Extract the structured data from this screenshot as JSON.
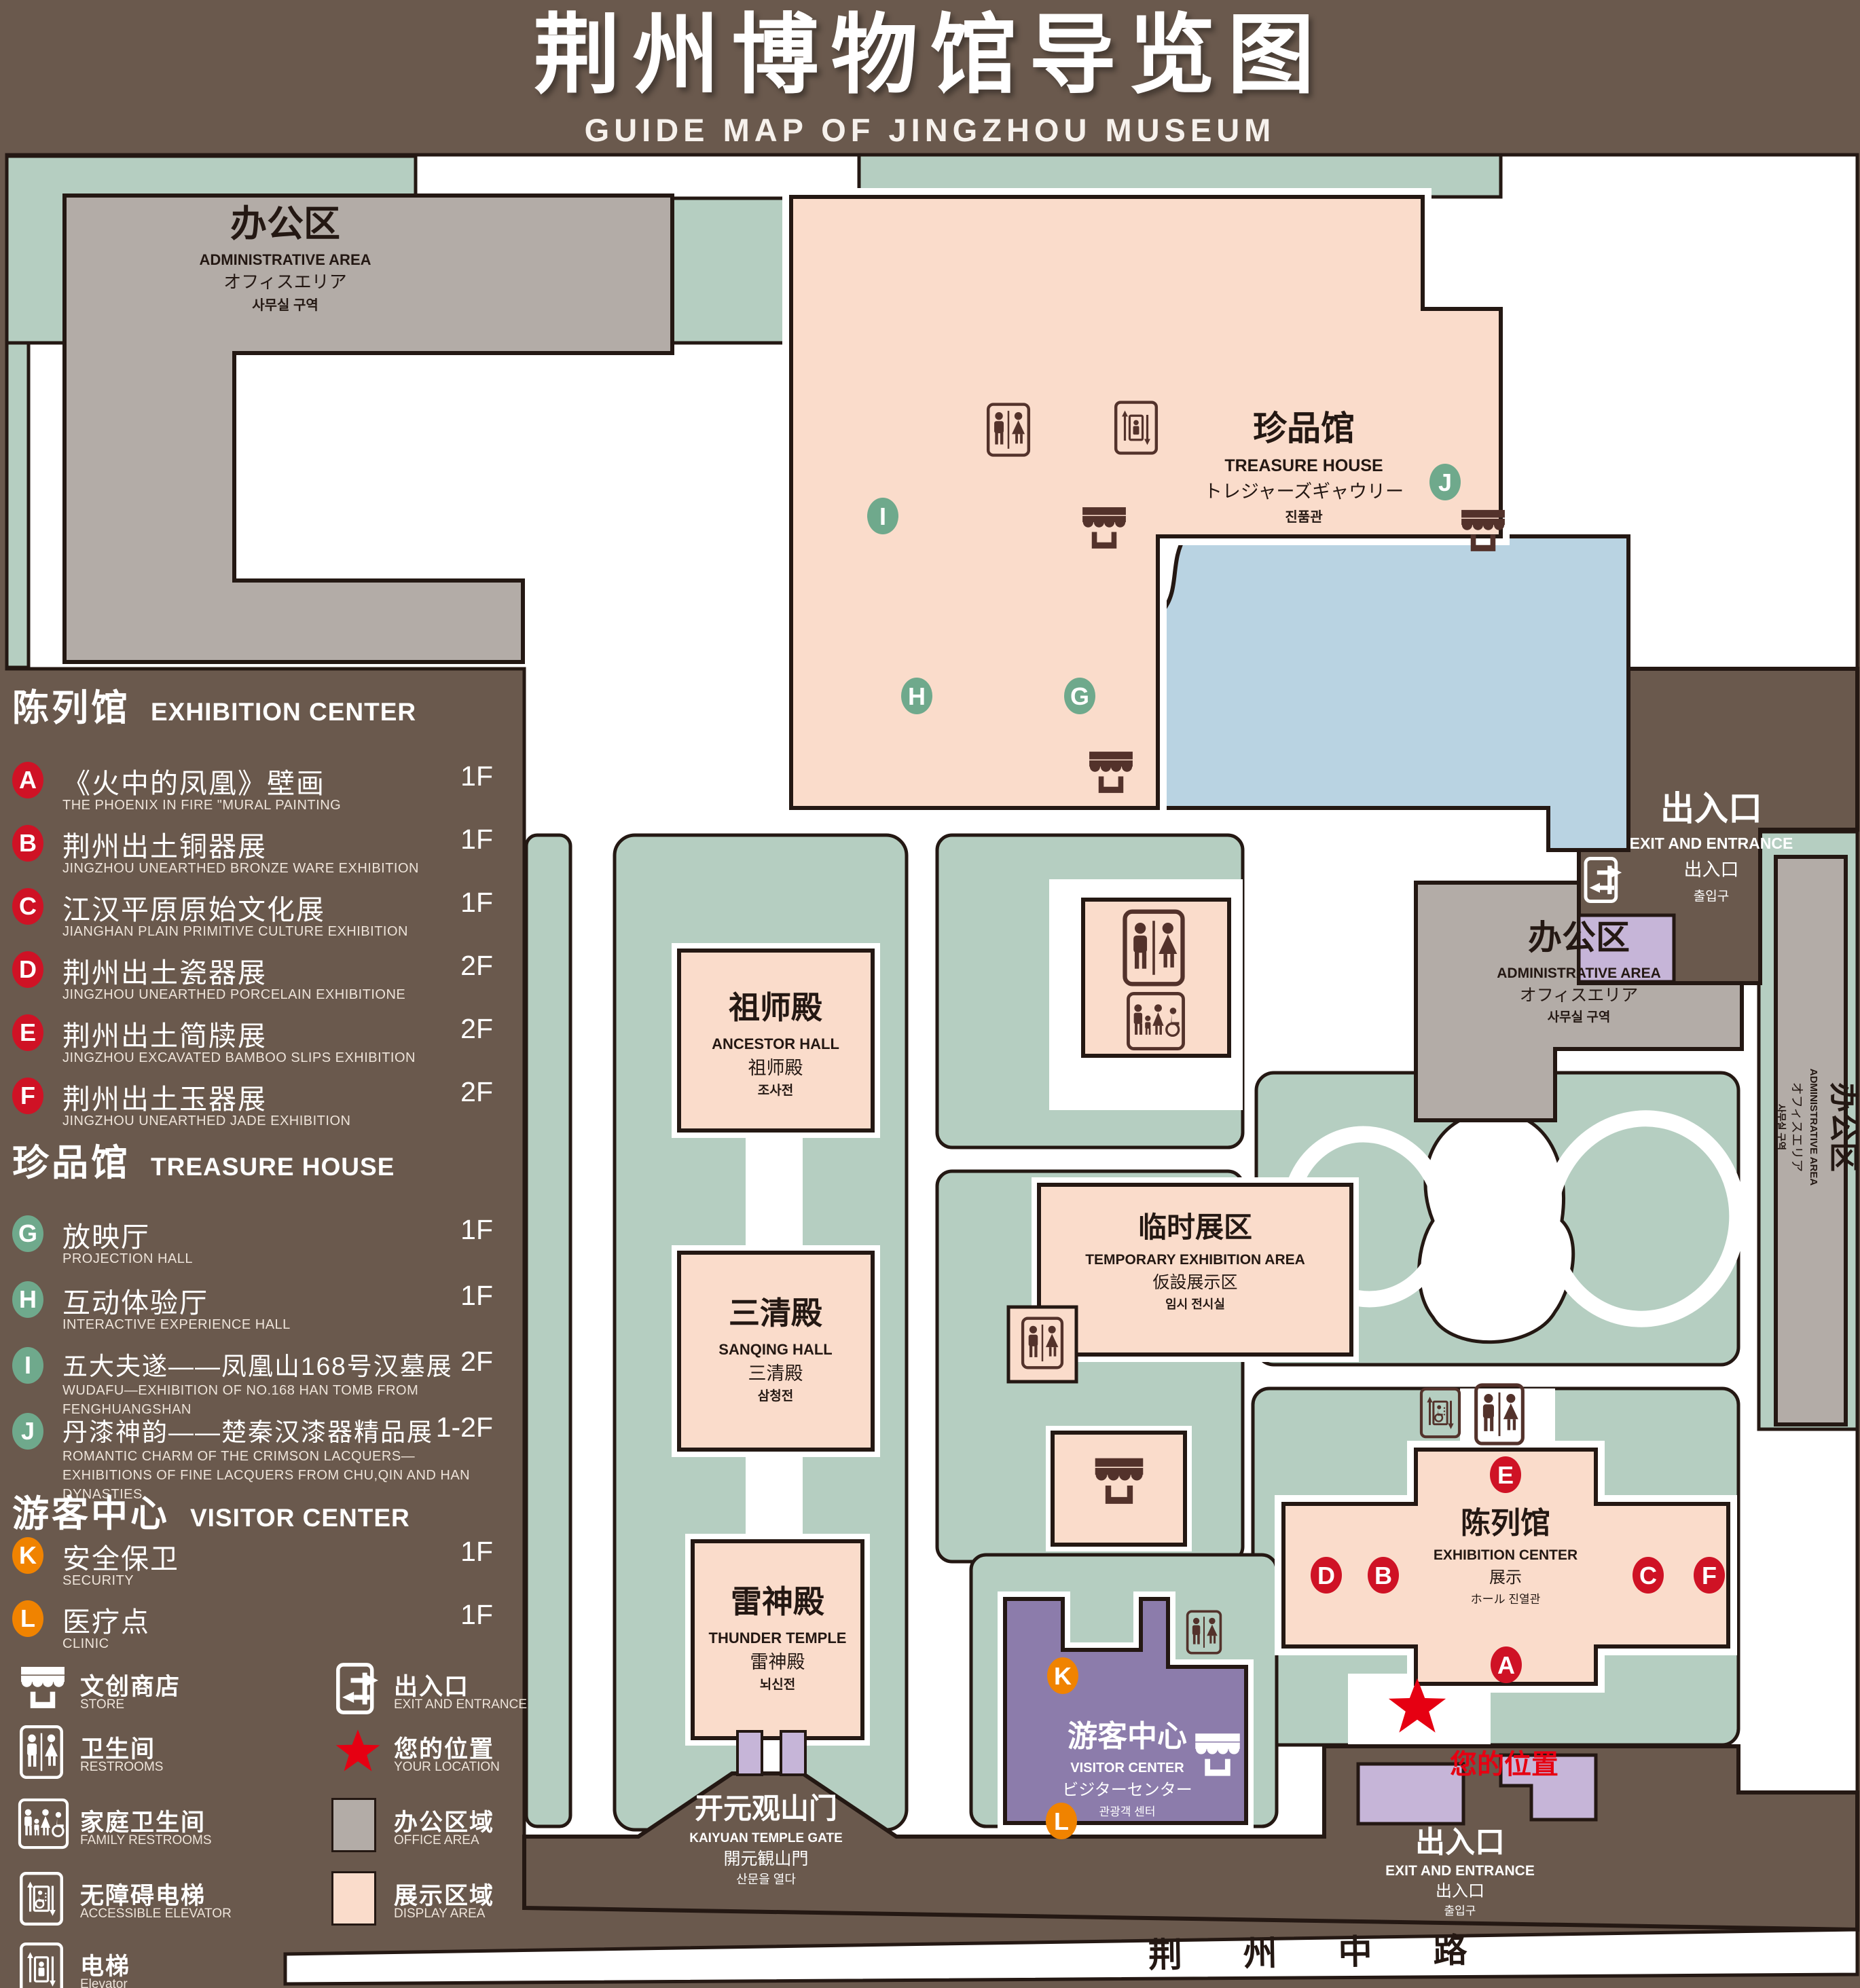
{
  "header": {
    "title": "荆州博物馆导览图",
    "subtitle": "GUIDE MAP OF JINGZHOU MUSEUM"
  },
  "legend": {
    "sections": [
      {
        "zh": "陈列馆",
        "en": "EXHIBITION CENTER",
        "items": [
          {
            "letter": "A",
            "zh": "《火中的凤凰》壁画",
            "en": "THE PHOENIX IN FIRE \"MURAL PAINTING",
            "floor": "1F"
          },
          {
            "letter": "B",
            "zh": "荆州出土铜器展",
            "en": "JINGZHOU UNEARTHED BRONZE WARE EXHIBITION",
            "floor": "1F"
          },
          {
            "letter": "C",
            "zh": "江汉平原原始文化展",
            "en": "JIANGHAN PLAIN PRIMITIVE CULTURE EXHIBITION",
            "floor": "1F"
          },
          {
            "letter": "D",
            "zh": "荆州出土瓷器展",
            "en": "JINGZHOU UNEARTHED PORCELAIN EXHIBITIONE",
            "floor": "2F"
          },
          {
            "letter": "E",
            "zh": "荆州出土简牍展",
            "en": "JINGZHOU EXCAVATED BAMBOO SLIPS EXHIBITION",
            "floor": "2F"
          },
          {
            "letter": "F",
            "zh": "荆州出土玉器展",
            "en": "JINGZHOU UNEARTHED JADE EXHIBITION",
            "floor": "2F"
          }
        ]
      },
      {
        "zh": "珍品馆",
        "en": "TREASURE HOUSE",
        "items": [
          {
            "letter": "G",
            "zh": "放映厅",
            "en": "PROJECTION HALL",
            "floor": "1F"
          },
          {
            "letter": "H",
            "zh": "互动体验厅",
            "en": "INTERACTIVE EXPERIENCE HALL",
            "floor": "1F"
          },
          {
            "letter": "I",
            "zh": "五大夫遂——凤凰山168号汉墓展",
            "en": "WUDAFU—EXHIBITION OF NO.168 HAN TOMB FROM FENGHUANGSHAN",
            "floor": "2F"
          },
          {
            "letter": "J",
            "zh": "丹漆神韵——楚秦汉漆器精品展",
            "en": "ROMANTIC CHARM OF THE CRIMSON LACQUERS—EXHIBITIONS OF FINE LACQUERS FROM CHU,QIN AND HAN DYNASTIES",
            "floor": "1-2F"
          }
        ]
      },
      {
        "zh": "游客中心",
        "en": "VISITOR CENTER",
        "items": [
          {
            "letter": "K",
            "zh": "安全保卫",
            "en": "SECURITY",
            "floor": "1F"
          },
          {
            "letter": "L",
            "zh": "医疗点",
            "en": "CLINIC",
            "floor": "1F"
          }
        ]
      }
    ]
  },
  "icon_legend": {
    "store": {
      "zh": "文创商店",
      "en": "STORE"
    },
    "exit": {
      "zh": "出入口",
      "en": "EXIT AND ENTRANCE"
    },
    "restrooms": {
      "zh": "卫生间",
      "en": "RESTROOMS"
    },
    "location": {
      "zh": "您的位置",
      "en": "YOUR LOCATION"
    },
    "family": {
      "zh": "家庭卫生间",
      "en": "FAMILY RESTROOMS"
    },
    "office": {
      "zh": "办公区域",
      "en": "OFFICE AREA"
    },
    "accessible": {
      "zh": "无障碍电梯",
      "en": "ACCESSIBLE ELEVATOR"
    },
    "display": {
      "zh": "展示区域",
      "en": "DISPLAY AREA"
    },
    "elevator": {
      "zh": "电梯",
      "en": "Elevator"
    }
  },
  "map": {
    "admin": {
      "zh": "办公区",
      "en": "ADMINISTRATIVE AREA",
      "jp": "オフィスエリア",
      "kr": "사무실 구역"
    },
    "treasure": {
      "zh": "珍品馆",
      "en": "TREASURE HOUSE",
      "jp": "トレジャーズギャウリー",
      "kr": "진품관"
    },
    "exit": {
      "zh": "出入口",
      "en": "EXIT AND ENTRANCE",
      "jp": "出入口",
      "kr": "출입구"
    },
    "ancestor": {
      "zh": "祖师殿",
      "en": "ANCESTOR HALL",
      "jp": "祖师殿",
      "kr": "조사전"
    },
    "sanqing": {
      "zh": "三清殿",
      "en": "SANQING HALL",
      "jp": "三清殿",
      "kr": "삼청전"
    },
    "thunder": {
      "zh": "雷神殿",
      "en": "THUNDER TEMPLE",
      "jp": "雷神殿",
      "kr": "뇌신전"
    },
    "temporary": {
      "zh": "临时展区",
      "en": "TEMPORARY EXHIBITION AREA",
      "jp": "仮設展示区",
      "kr": "임시 전시실"
    },
    "visitor": {
      "zh": "游客中心",
      "en": "VISITOR CENTER",
      "jp": "ビジターセンター",
      "kr": "관광객 센터"
    },
    "exhibition": {
      "zh": "陈列馆",
      "en": "EXHIBITION CENTER",
      "jp": "展示",
      "kr": "ホール 진열관"
    },
    "gate": {
      "zh": "开元观山门",
      "en": "KAIYUAN TEMPLE GATE",
      "jp": "開元観山門",
      "kr": "산문을 열다"
    },
    "road": "荆 州 中 路",
    "your_location": "您的位置"
  },
  "colors": {
    "background": "#6a594d",
    "path_green": "#b5cec1",
    "display_area": "#fadccb",
    "office_area": "#b3aca7",
    "water": "#b9d3e2",
    "visitor_purple": "#8c7cab",
    "gate_purple": "#c6b5d8",
    "badge_red": "#cf1225",
    "badge_green": "#6fa98c",
    "badge_orange": "#f08300",
    "star_red": "#e60012",
    "icon_brown": "#53322b"
  }
}
